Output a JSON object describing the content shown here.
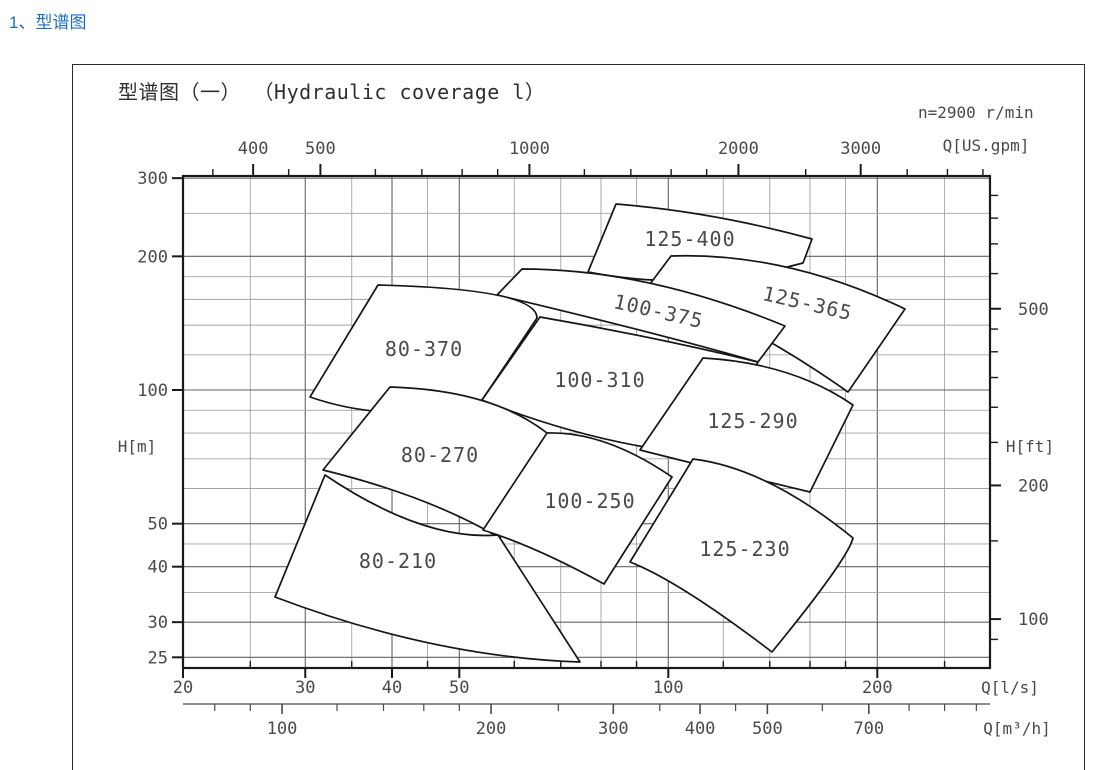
{
  "page": {
    "header": "1、型谱图"
  },
  "chart": {
    "title": "型谱图（一） （Hydraulic coverage l）",
    "speed_note": "n=2900 r/min",
    "axis_labels": {
      "top": "Q[US.gpm]",
      "left": "H[m]",
      "right": "H[ft]",
      "bottom_ls": "Q[l/s]",
      "bottom_m3h": "Q[m³/h]"
    }
  },
  "chart_data": {
    "type": "coverage-map",
    "title": "型谱图（一） （Hydraulic coverage l）",
    "pump_speed_rpm": 2900,
    "x_axis_ls": {
      "unit": "l/s",
      "scale": "log",
      "range": [
        20,
        290
      ],
      "labeled_ticks": [
        20,
        30,
        40,
        50,
        100,
        200
      ],
      "minor_ticks": [
        25,
        35,
        45,
        60,
        70,
        80,
        90,
        120,
        140,
        160,
        180,
        250
      ]
    },
    "x_axis_m3h": {
      "unit": "m³/h",
      "labeled_ticks": [
        100,
        200,
        300,
        400,
        500,
        700
      ],
      "minor_ticks": [
        80,
        90,
        120,
        140,
        160,
        180,
        250,
        350,
        450,
        600,
        800,
        900,
        1000
      ]
    },
    "x_axis_usgpm": {
      "unit": "US.gpm",
      "labeled_ticks": [
        400,
        500,
        1000,
        2000,
        3000
      ],
      "minor_ticks": [
        350,
        450,
        600,
        700,
        800,
        900,
        1200,
        1400,
        1600,
        1800,
        2500,
        3500,
        4000,
        4500
      ]
    },
    "y_axis_m": {
      "unit": "m",
      "scale": "log",
      "range": [
        23,
        300
      ],
      "labeled_ticks": [
        25,
        30,
        40,
        50,
        100,
        200,
        300
      ],
      "minor_ticks": [
        35,
        45,
        60,
        70,
        80,
        90,
        120,
        140,
        160,
        180,
        250
      ]
    },
    "y_axis_ft": {
      "unit": "ft",
      "labeled_ticks": [
        100,
        200,
        500
      ],
      "minor_ticks": [
        90,
        150,
        250,
        300,
        350,
        400,
        450,
        600,
        700,
        800,
        900
      ]
    },
    "scale": {
      "x0_px": 183,
      "x0_q_ls": 20,
      "px_per_decade_x": 694.3,
      "y0_px": 390,
      "y0_h_m": 100,
      "px_per_decade_y": 444,
      "ls_per_m3h": 3.6,
      "ls_per_usgpm": 15.85,
      "m_per_ft": 3.2808,
      "frame_px": {
        "left": 183,
        "right": 990,
        "top": 176,
        "bottom": 668
      },
      "m3h_axis_y_px": 704
    },
    "regions": [
      {
        "label": "125-400",
        "tl": [
          616,
          204
        ],
        "c_top": [
          714,
          212
        ],
        "tr": [
          812,
          239
        ],
        "br": [
          803,
          263
        ],
        "c_bot": [
          695,
          293
        ],
        "bl": [
          588,
          272
        ],
        "label_pos": [
          690,
          239
        ],
        "label_rot": 0
      },
      {
        "label": "125-365",
        "tl": [
          671,
          256
        ],
        "c_top": [
          786,
          252
        ],
        "tr": [
          905,
          309
        ],
        "br": [
          848,
          392
        ],
        "c_bot": [
          752,
          324
        ],
        "bl": [
          650,
          284
        ],
        "label_pos": [
          806,
          303
        ],
        "label_rot": 13
      },
      {
        "label": "100-375",
        "tl": [
          522,
          269
        ],
        "c_top": [
          647,
          269
        ],
        "tr": [
          785,
          326
        ],
        "br": [
          758,
          362
        ],
        "c_bot": [
          653,
          332
        ],
        "bl": [
          497,
          295
        ],
        "label_pos": [
          657,
          311
        ],
        "label_rot": 13
      },
      {
        "label": "80-370",
        "tl": [
          378,
          285
        ],
        "c_top": [
          537,
          289
        ],
        "tr": [
          537,
          318
        ],
        "br": [
          482,
          400
        ],
        "c_bot": [
          394,
          426
        ],
        "bl": [
          310,
          397
        ],
        "label_pos": [
          424,
          349
        ],
        "label_rot": 0
      },
      {
        "label": "100-310",
        "tl": [
          540,
          317
        ],
        "c_top": [
          650,
          336
        ],
        "tr": [
          758,
          362
        ],
        "br": [
          700,
          455
        ],
        "c_bot": [
          589,
          443
        ],
        "bl": [
          482,
          400
        ],
        "label_pos": [
          600,
          380
        ],
        "label_rot": 0
      },
      {
        "label": "125-290",
        "tl": [
          703,
          358
        ],
        "c_top": [
          792,
          363
        ],
        "tr": [
          853,
          405
        ],
        "br": [
          810,
          492
        ],
        "c_bot": [
          715,
          469
        ],
        "bl": [
          640,
          450
        ],
        "label_pos": [
          753,
          421
        ],
        "label_rot": 0
      },
      {
        "label": "80-270",
        "tl": [
          390,
          387
        ],
        "c_top": [
          492,
          390
        ],
        "tr": [
          547,
          433
        ],
        "br": [
          500,
          538
        ],
        "c_bot": [
          429,
          496
        ],
        "bl": [
          323,
          470
        ],
        "label_pos": [
          440,
          455
        ],
        "label_rot": 0
      },
      {
        "label": "100-250",
        "tl": [
          547,
          433
        ],
        "c_top": [
          605,
          431
        ],
        "tr": [
          672,
          477
        ],
        "br": [
          604,
          584
        ],
        "c_bot": [
          537,
          547
        ],
        "bl": [
          483,
          530
        ],
        "label_pos": [
          590,
          501
        ],
        "label_rot": 0
      },
      {
        "label": "125-230",
        "tl": [
          693,
          459
        ],
        "c_top": [
          767,
          468
        ],
        "tr": [
          853,
          538
        ],
        "c_right": [
          848,
          559
        ],
        "br": [
          772,
          652
        ],
        "c_bot": [
          679,
          581
        ],
        "bl": [
          630,
          562
        ],
        "label_pos": [
          745,
          549
        ],
        "label_rot": 0
      },
      {
        "label": "80-210",
        "tl": [
          325,
          475
        ],
        "c_top": [
          423,
          541
        ],
        "tr": [
          498,
          535
        ],
        "br": [
          580,
          662
        ],
        "c_bot": [
          433,
          657
        ],
        "bl": [
          275,
          597
        ],
        "label_pos": [
          398,
          561
        ],
        "label_rot": 0
      }
    ]
  }
}
